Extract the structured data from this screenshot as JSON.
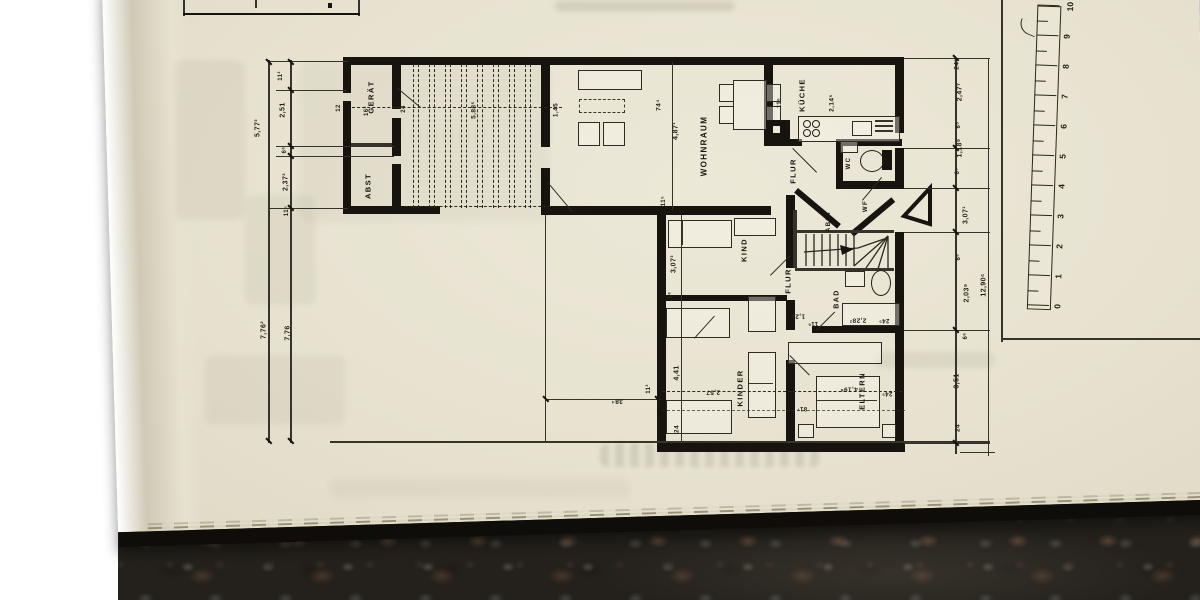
{
  "plan": {
    "room_labels": [
      {
        "id": "room-label-geraet",
        "text": "GERÄT",
        "x": 371,
        "y": 97,
        "rot": -90,
        "fs": 7.5
      },
      {
        "id": "room-label-abst-1",
        "text": "ABST",
        "x": 368,
        "y": 186,
        "rot": -90,
        "fs": 7.5
      },
      {
        "id": "room-label-wohnraum",
        "text": "WOHNRAUM",
        "x": 704,
        "y": 146,
        "rot": -90,
        "fs": 8
      },
      {
        "id": "room-label-kueche",
        "text": "KÜCHE",
        "x": 802,
        "y": 95,
        "rot": -90,
        "fs": 7.5
      },
      {
        "id": "room-label-flur-1",
        "text": "FLUR",
        "x": 793,
        "y": 171,
        "rot": -90,
        "fs": 7.5
      },
      {
        "id": "room-label-wc",
        "text": "WC",
        "x": 849,
        "y": 163,
        "rot": -90,
        "fs": 6
      },
      {
        "id": "room-label-wf",
        "text": "WF",
        "x": 866,
        "y": 206,
        "rot": -90,
        "fs": 6
      },
      {
        "id": "room-label-abst-2",
        "text": "ABST",
        "x": 829,
        "y": 221,
        "rot": -90,
        "fs": 6
      },
      {
        "id": "room-label-flur-2",
        "text": "FLUR",
        "x": 788,
        "y": 281,
        "rot": -90,
        "fs": 7.5
      },
      {
        "id": "room-label-bad",
        "text": "BAD",
        "x": 837,
        "y": 299,
        "rot": -90,
        "fs": 7
      },
      {
        "id": "room-label-kind",
        "text": "KIND",
        "x": 744,
        "y": 250,
        "rot": -90,
        "fs": 7.5
      },
      {
        "id": "room-label-kinder",
        "text": "KINDER",
        "x": 740,
        "y": 388,
        "rot": -90,
        "fs": 7.5
      },
      {
        "id": "room-label-eltern",
        "text": "ELTERN",
        "x": 862,
        "y": 391,
        "rot": -90,
        "fs": 7.5
      }
    ],
    "dim_labels": [
      {
        "text": "5,77³",
        "x": 258,
        "y": 128,
        "rot": -90,
        "fs": 7
      },
      {
        "text": "7,76²",
        "x": 264,
        "y": 330,
        "rot": -90,
        "fs": 7
      },
      {
        "text": "11²",
        "x": 281,
        "y": 76,
        "rot": -90,
        "fs": 6
      },
      {
        "text": "2,51",
        "x": 283,
        "y": 110,
        "rot": -90,
        "fs": 7
      },
      {
        "text": "6⁶",
        "x": 285,
        "y": 150,
        "rot": -90,
        "fs": 6
      },
      {
        "text": "2,37³",
        "x": 286,
        "y": 182,
        "rot": -90,
        "fs": 7
      },
      {
        "text": "11⁵",
        "x": 287,
        "y": 211,
        "rot": -90,
        "fs": 6
      },
      {
        "text": "7,76",
        "x": 288,
        "y": 333,
        "rot": -90,
        "fs": 7
      },
      {
        "text": "12",
        "x": 339,
        "y": 108,
        "rot": -90,
        "fs": 6
      },
      {
        "text": "16³",
        "x": 367,
        "y": 111,
        "rot": -90,
        "fs": 6
      },
      {
        "text": "24",
        "x": 404,
        "y": 109,
        "rot": -90,
        "fs": 6
      },
      {
        "text": "5,88⁵",
        "x": 474,
        "y": 110,
        "rot": -90,
        "fs": 6.5
      },
      {
        "text": "1,45",
        "x": 556,
        "y": 110,
        "rot": -90,
        "fs": 6.5
      },
      {
        "text": "74⁴",
        "x": 659,
        "y": 105,
        "rot": -90,
        "fs": 6.5
      },
      {
        "text": "4,87¹",
        "x": 676,
        "y": 131,
        "rot": -90,
        "fs": 7
      },
      {
        "text": "11⁵",
        "x": 664,
        "y": 201,
        "rot": -90,
        "fs": 6
      },
      {
        "text": "11⁶",
        "x": 780,
        "y": 103,
        "rot": -90,
        "fs": 6
      },
      {
        "text": "2,14⁵",
        "x": 832,
        "y": 103,
        "rot": -90,
        "fs": 6.5
      },
      {
        "text": "24⁵",
        "x": 957,
        "y": 64,
        "rot": -90,
        "fs": 6.5
      },
      {
        "text": "2,47⁷",
        "x": 960,
        "y": 92,
        "rot": -90,
        "fs": 7
      },
      {
        "text": "6⁵",
        "x": 959,
        "y": 125,
        "rot": -90,
        "fs": 6
      },
      {
        "text": "1,18⁹",
        "x": 960,
        "y": 148,
        "rot": -90,
        "fs": 7
      },
      {
        "text": "6⁵",
        "x": 958,
        "y": 171,
        "rot": -90,
        "fs": 6
      },
      {
        "text": "3,07¹",
        "x": 966,
        "y": 215,
        "rot": -90,
        "fs": 7
      },
      {
        "text": "6⁶",
        "x": 959,
        "y": 257,
        "rot": -90,
        "fs": 6
      },
      {
        "text": "2,03⁹",
        "x": 967,
        "y": 293,
        "rot": -90,
        "fs": 7
      },
      {
        "text": "6⁶",
        "x": 966,
        "y": 336,
        "rot": -90,
        "fs": 6
      },
      {
        "text": "3,51",
        "x": 957,
        "y": 381,
        "rot": -90,
        "fs": 7
      },
      {
        "text": "24",
        "x": 958,
        "y": 428,
        "rot": -90,
        "fs": 6.5
      },
      {
        "text": "12,90⁶",
        "x": 984,
        "y": 285,
        "rot": -90,
        "fs": 7
      },
      {
        "text": "3,07³",
        "x": 674,
        "y": 264,
        "rot": -90,
        "fs": 7
      },
      {
        "text": "6⁶",
        "x": 671,
        "y": 295,
        "rot": -90,
        "fs": 6
      },
      {
        "text": "4,41",
        "x": 677,
        "y": 373,
        "rot": -90,
        "fs": 7
      },
      {
        "text": "24",
        "x": 677,
        "y": 429,
        "rot": -90,
        "fs": 6.5
      },
      {
        "text": "11³",
        "x": 649,
        "y": 389,
        "rot": -90,
        "fs": 6
      },
      {
        "text": "38⁴",
        "x": 617,
        "y": 401,
        "rot": 180,
        "fs": 6.5
      },
      {
        "text": "2,57",
        "x": 713,
        "y": 392,
        "rot": 180,
        "fs": 6.5
      },
      {
        "text": "1,26",
        "x": 798,
        "y": 316,
        "rot": 180,
        "fs": 6.5
      },
      {
        "text": "11⁶",
        "x": 813,
        "y": 323,
        "rot": 180,
        "fs": 6
      },
      {
        "text": "2,28²",
        "x": 858,
        "y": 320,
        "rot": 180,
        "fs": 6.5
      },
      {
        "text": "24⁵",
        "x": 884,
        "y": 320,
        "rot": 180,
        "fs": 6
      },
      {
        "text": "4,19⁸",
        "x": 849,
        "y": 389,
        "rot": 180,
        "fs": 6.5
      },
      {
        "text": "81⁷",
        "x": 802,
        "y": 408,
        "rot": 180,
        "fs": 6
      },
      {
        "text": "24⁵",
        "x": 887,
        "y": 393,
        "rot": 180,
        "fs": 6
      }
    ],
    "scale_bar": {
      "numbers": [
        "0",
        "1",
        "2",
        "3",
        "4",
        "5",
        "6",
        "7",
        "8",
        "9",
        "10"
      ]
    }
  },
  "colors": {
    "paper": "#e8e4d3",
    "ink": "#17140f",
    "book_cover_edge": "#0f0d09",
    "granite": "#24211c",
    "background": "#ffffff"
  }
}
